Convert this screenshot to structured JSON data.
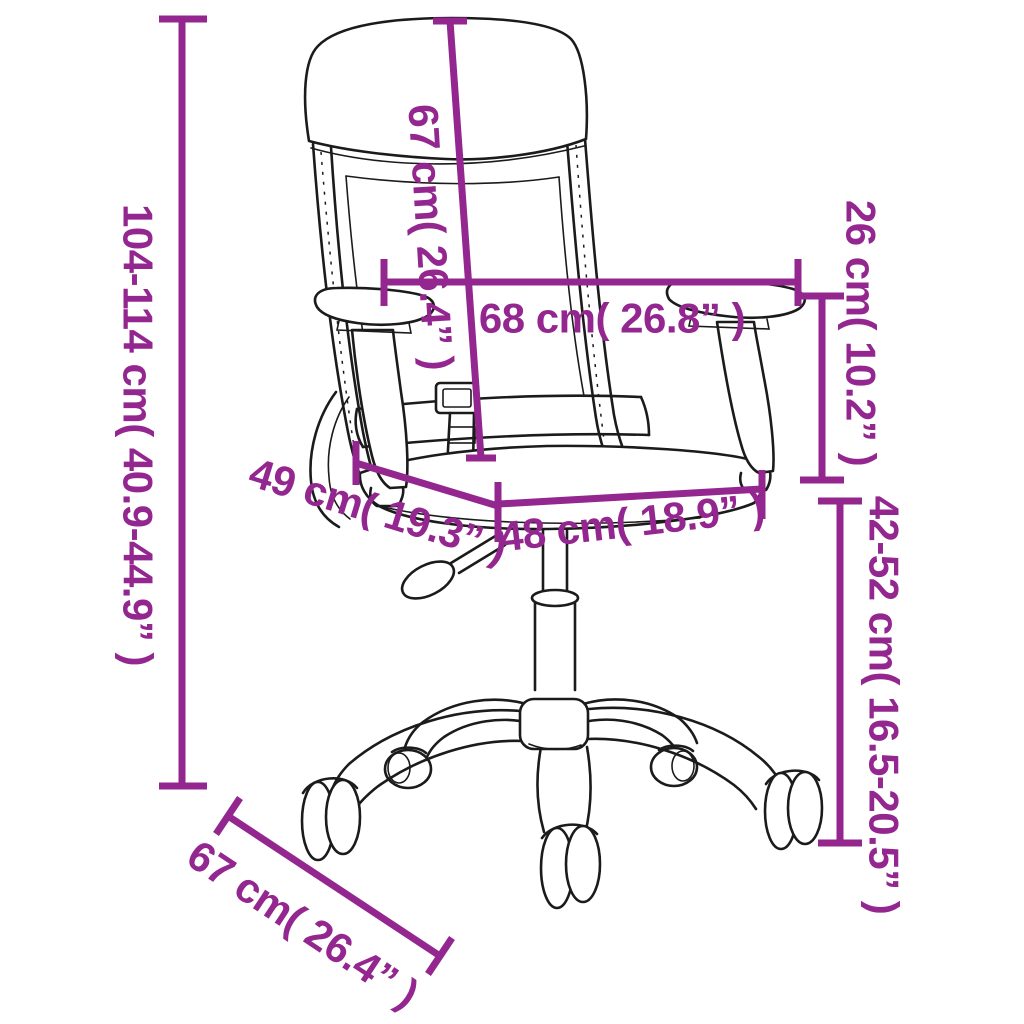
{
  "figure": {
    "subject": "office-chair-line-drawing",
    "style": "product-dimension-diagram",
    "accent_color": "#93278F",
    "line_color": "#1b1b1b",
    "background_color": "#ffffff"
  },
  "dimensions": {
    "overall_height": {
      "cm": "104-114",
      "in": "40.9-44.9",
      "label": "104-114 cm( 40.9-44.9” )"
    },
    "backrest_height": {
      "cm": "67",
      "in": "26.4",
      "label": "67 cm( 26.4” )"
    },
    "width_across_armrests": {
      "cm": "68",
      "in": "26.8",
      "label": "68 cm( 26.8” )"
    },
    "armrest_height": {
      "cm": "26",
      "in": "10.2",
      "label": "26 cm( 10.2” )"
    },
    "seat_depth": {
      "cm": "49",
      "in": "19.3",
      "label": "49 cm( 19.3” )"
    },
    "seat_width": {
      "cm": "48",
      "in": "18.9",
      "label": "48 cm( 18.9” )"
    },
    "seat_height": {
      "cm": "42-52",
      "in": "16.5-20.5",
      "label": "42-52 cm( 16.5-20.5” )"
    },
    "base_depth": {
      "cm": "67",
      "in": "26.4",
      "label": "67 cm( 26.4” )"
    }
  }
}
